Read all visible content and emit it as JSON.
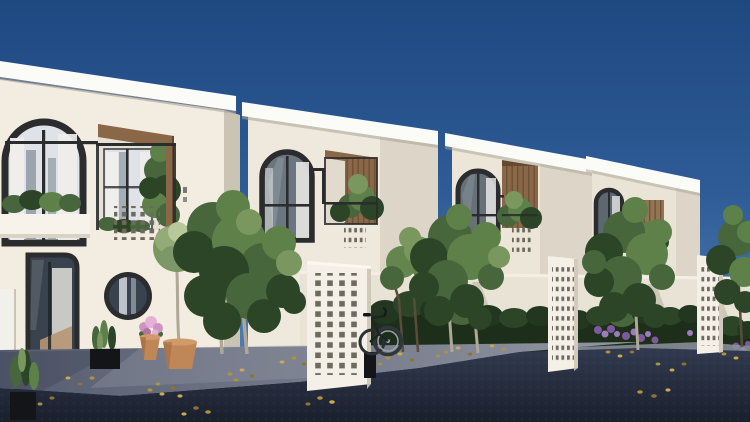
{
  "scene": {
    "type": "3d-architectural-exterior-render",
    "description": "Daytime 3D render of a row of four modern white two-storey townhouses receding to the right under a clear deep-blue sky. Each house has a flat overhanging white roof, a black-framed arched window with white curtains, a recessed balcony lined with warm wood and filled with plants, and grids of small square perforations in the facade. Freestanding white perforated breeze-block screen walls stand along the street, with clipped dark-green hedges, purple flowering shrubs, slender trees, a leaning bicycle, terracotta pots with a topiary tree and pink flowers, black planters, a light concrete driveway strewn with golden fallen leaves, and a dark asphalt road in the foreground.",
    "time_of_day": "clear sunny day",
    "inventory": {
      "townhouses": 4,
      "arched_windows": 4,
      "round_window": 1,
      "perforated_screens": 3,
      "facade_perforation_grids": 3,
      "trees": 5,
      "hedges": 3,
      "bicycle": 1,
      "terracotta_pots": 2,
      "black_planters": 3,
      "purple_flower_clusters": 2,
      "pink_flower_pot": 1
    },
    "houses": [
      {
        "position": "leftmost",
        "features": "arched window, balcony with plants, perforation grid, round porthole window, tall glass door, potted topiary"
      },
      {
        "position": "second",
        "features": "arched window, wood-lined balcony, perforation grid, tall perforated screen with bicycle"
      },
      {
        "position": "third",
        "features": "arched window, wood slat balcony, perforation grid, perforated screen"
      },
      {
        "position": "fourth",
        "features": "arched window, roof overhang, perforated pillar, tree in front"
      }
    ]
  },
  "colors": {
    "skyTop": "#1e4880",
    "skyMid": "#2f5c97",
    "skyLow": "#4d7db2",
    "wallLit": "#f2ece1",
    "wallMid": "#efe9dd",
    "wallTone": "#ece6d9",
    "wallWarm": "#eae4d6",
    "wallShade": "#ddd6c8",
    "wallDark": "#cbc4b5",
    "roofWhite": "#fbfbf7",
    "roofShadow": "#a8a296",
    "frame": "#2a2c2e",
    "glassLight": "#dfe3e8",
    "glassMid": "#8b959f",
    "glassDark": "#39434f",
    "curtain": "#efeeea",
    "interiorLight": "#d5d4cf",
    "interiorWood": "#b59671",
    "wood": "#8a6746",
    "woodDark": "#63492f",
    "screenLit": "#f4f0e7",
    "holeDark": "#6f6a60",
    "leafDark": "#2c4527",
    "leafMid": "#47663c",
    "leafLight": "#5d8148",
    "leafPale": "#79975e",
    "leafBright": "#93ab76",
    "leafTop": "#b7c99a",
    "hedgeDark": "#223620",
    "hedgeBase": "#1d2e1a",
    "trunk": "#b0a896",
    "branch": "#5a4c3b",
    "road": "#323b50",
    "roadDark": "#1a1f2c",
    "driveway": "#596073",
    "drivewayLit": "#9297a3",
    "curb": "#8d92a0",
    "pot": "#bf8757",
    "potRim": "#d09a6b",
    "potShade": "#935f38",
    "planter": "#141519",
    "gold": "#b2903f",
    "goldLight": "#cfa94e",
    "goldDark": "#8f7330",
    "purple": "#7d5a9e",
    "purpleLight": "#9d7cbc",
    "pink": "#cf93c1",
    "pinkLight": "#e3b1d6"
  }
}
